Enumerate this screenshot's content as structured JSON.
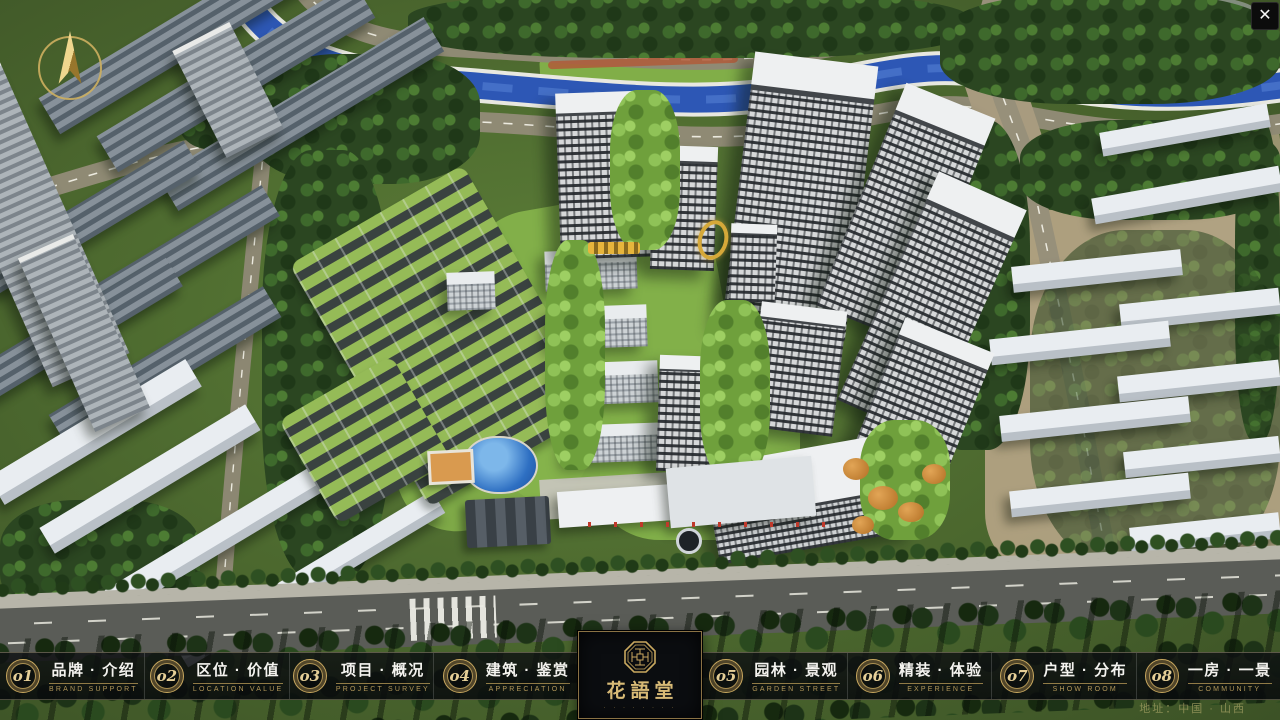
{
  "ui": {
    "close_glyph": "✕",
    "address": "地址：中国 · 山西",
    "logo": {
      "name": "花語堂",
      "caption": "· · · · · · · ·"
    },
    "nav": {
      "items": [
        {
          "num": "o1",
          "title": "品牌 · 介绍",
          "subtitle": "BRAND SUPPORT"
        },
        {
          "num": "o2",
          "title": "区位 · 价值",
          "subtitle": "LOCATION VALUE"
        },
        {
          "num": "o3",
          "title": "项目 · 概况",
          "subtitle": "PROJECT SURVEY"
        },
        {
          "num": "o4",
          "title": "建筑 · 鉴赏",
          "subtitle": "APPRECIATION"
        },
        {
          "num": "o5",
          "title": "园林 · 景观",
          "subtitle": "GARDEN STREET"
        },
        {
          "num": "o6",
          "title": "精装 · 体验",
          "subtitle": "EXPERIENCE"
        },
        {
          "num": "o7",
          "title": "户型 · 分布",
          "subtitle": "SHOW ROOM"
        },
        {
          "num": "o8",
          "title": "一房 · 一景",
          "subtitle": "COMMUNITY"
        }
      ]
    },
    "palette": {
      "accent_gold": "#C9A85F",
      "bar_background": "#0B0D10",
      "river_blue": "#2D57B5",
      "lawn_green": "#86B44B",
      "tree_dark_green": "#2B4621",
      "tower_facade": "#D6D8D9",
      "roof_white": "#EEF0F1",
      "riverside_road": "#8F8A74",
      "main_road": "#5A5C57"
    }
  }
}
